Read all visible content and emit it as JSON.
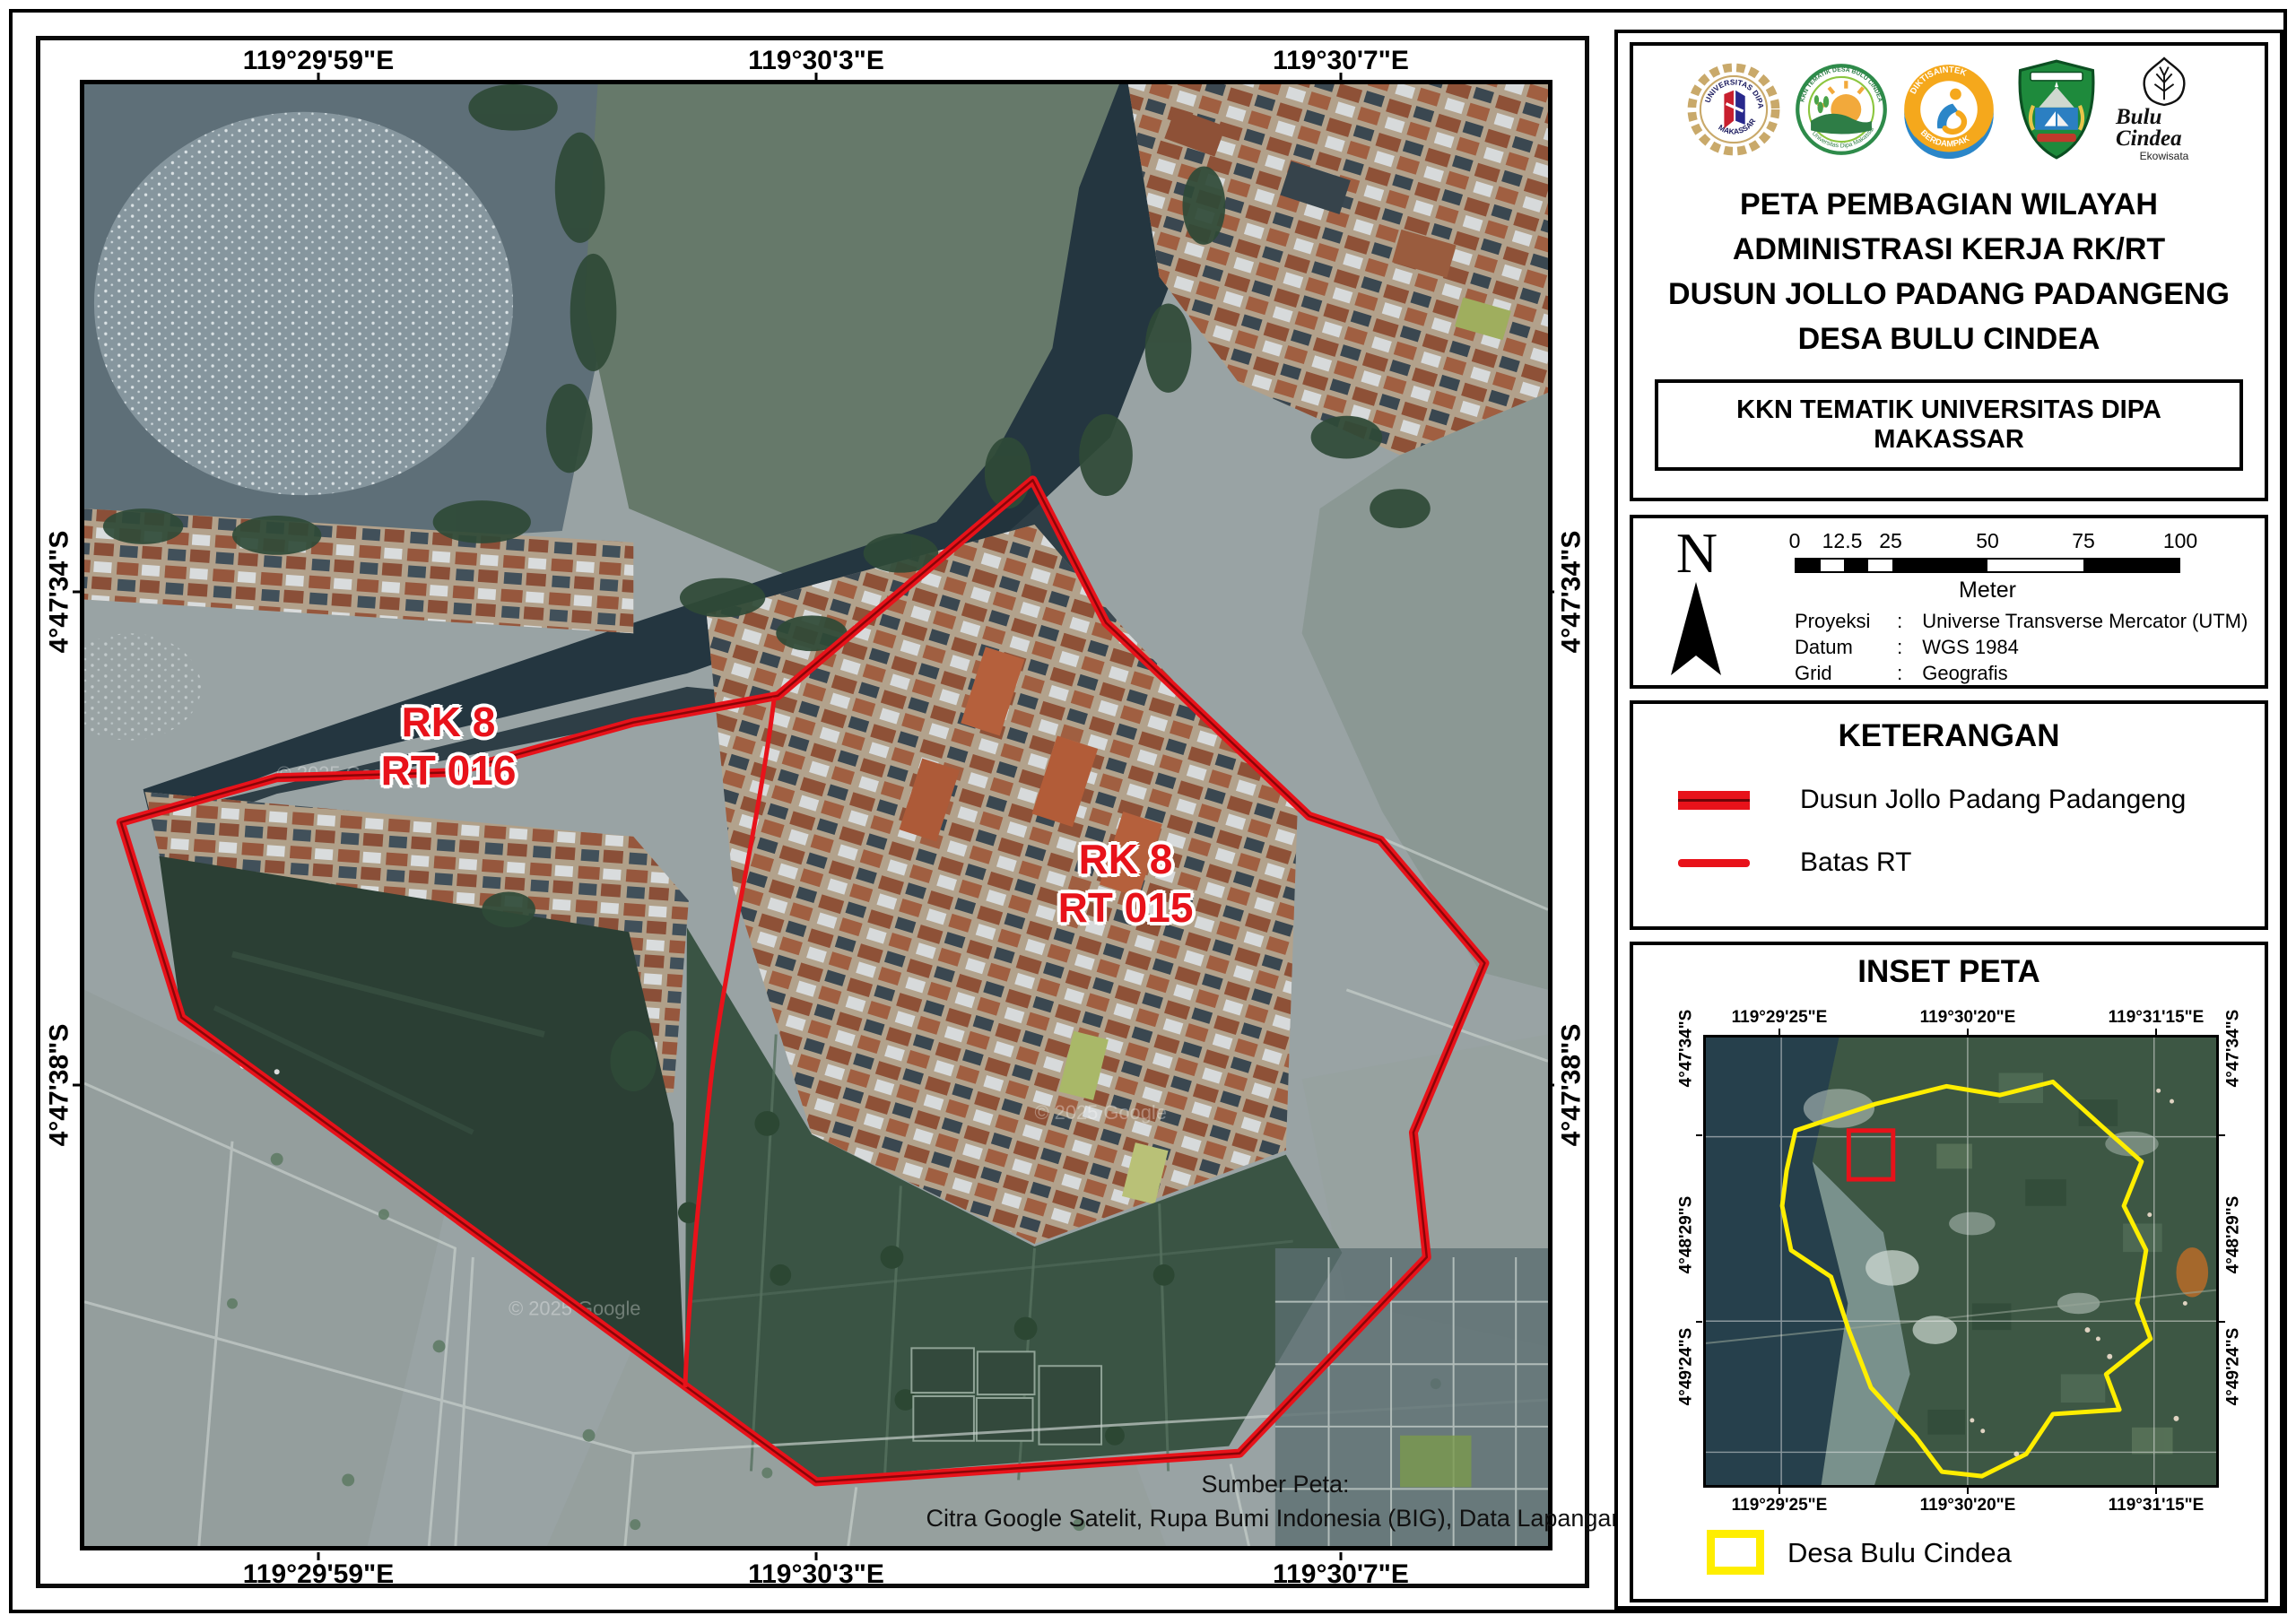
{
  "colors": {
    "boundary_red": "#e8121a",
    "batas_rt_red": "#e8121a",
    "desa_yellow": "#ffee00",
    "pond_dark_green": "#2b3f34",
    "water_green": "#66796a"
  },
  "main_map": {
    "lon_labels": [
      "119°29'59\"E",
      "119°30'3\"E",
      "119°30'7\"E"
    ],
    "lat_labels": [
      "4°47'34\"S",
      "4°47'38\"S"
    ],
    "regions": [
      {
        "line1": "RK 8",
        "line2": "RT 016"
      },
      {
        "line1": "RK 8",
        "line2": "RT 015"
      }
    ],
    "source_title": "Sumber Peta:",
    "source_line": "Citra Google Satelit, Rupa Bumi Indonesia (BIG), Data Lapangan",
    "watermark": "© 2025 Google"
  },
  "title_panel": {
    "logos": {
      "udm_top": "UNIVERSITAS DIPA",
      "udm_bottom": "MAKASSAR",
      "kkn_top": "KKN TEMATIK DESA BULU CINDEA",
      "kkn_bottom": "Universitas Dipa Makassar",
      "dikti_top": "DIKTISAINTEK",
      "dikti_bottom": "BERDAMPAK",
      "bulu_script": "Bulu Cindea",
      "bulu_sub": "Ekowisata"
    },
    "title_lines": [
      "PETA PEMBAGIAN WILAYAH",
      "ADMINISTRASI KERJA RK/RT",
      "DUSUN JOLLO PADANG PADANGENG",
      "DESA BULU CINDEA"
    ],
    "subtitle": "KKN TEMATIK UNIVERSITAS DIPA MAKASSAR"
  },
  "scale_panel": {
    "north_label": "N",
    "ticks": [
      "0",
      "12.5",
      "25",
      "50",
      "75",
      "100"
    ],
    "unit": "Meter",
    "info": [
      {
        "label": "Proyeksi",
        "sep": ":",
        "value": "Universe Transverse Mercator (UTM)"
      },
      {
        "label": "Datum",
        "sep": ":",
        "value": "WGS 1984"
      },
      {
        "label": "Grid",
        "sep": ":",
        "value": "Geografis"
      }
    ]
  },
  "legend_panel": {
    "title": "KETERANGAN",
    "items": [
      {
        "label": "Dusun Jollo Padang Padangeng",
        "swatch": "thick-red-line"
      },
      {
        "label": "Batas RT",
        "swatch": "thin-red-line"
      }
    ]
  },
  "inset_panel": {
    "title": "INSET PETA",
    "lon_labels": [
      "119°29'25\"E",
      "119°30'20\"E",
      "119°31'15\"E"
    ],
    "lat_labels": [
      "4°47'34\"S",
      "4°48'29\"S",
      "4°49'24\"S"
    ],
    "legend_label": "Desa Bulu Cindea"
  }
}
